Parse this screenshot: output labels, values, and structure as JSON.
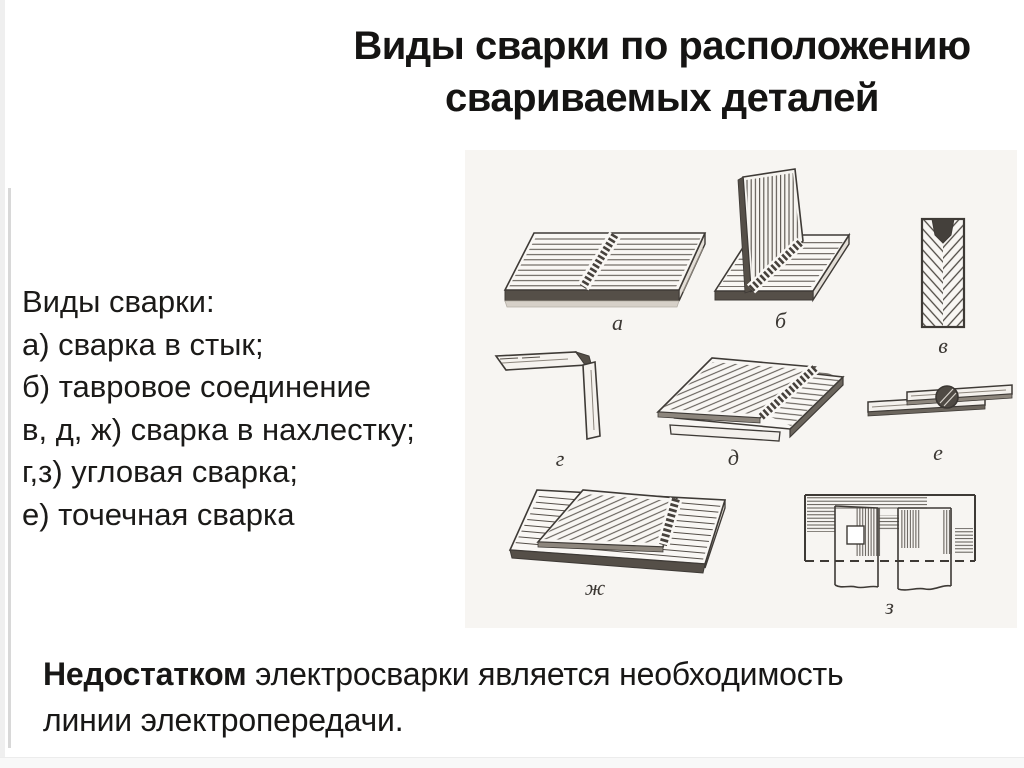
{
  "slide": {
    "title_line1": "Виды сварки по расположению",
    "title_line2": "свариваемых деталей",
    "legend": {
      "heading": "Виды сварки:",
      "items": [
        "а) сварка в стык;",
        "б) тавровое соединение",
        "в, д, ж) сварка в нахлестку;",
        "г,з) угловая сварка;",
        "е) точечная сварка"
      ]
    },
    "figure_labels": {
      "a": "а",
      "b": "б",
      "v": "в",
      "g": "г",
      "d": "д",
      "e": "е",
      "zh": "ж",
      "z": "з"
    },
    "footer": {
      "lead": "Недостатком",
      "line1_rest": " электросварки является необходимость",
      "line2": "линии электропередачи."
    },
    "colors": {
      "text": "#1b1a18",
      "sketch_stroke": "#3e3a36",
      "weld_dark": "#554f48",
      "rule_gray": "#d8d8d8"
    }
  }
}
